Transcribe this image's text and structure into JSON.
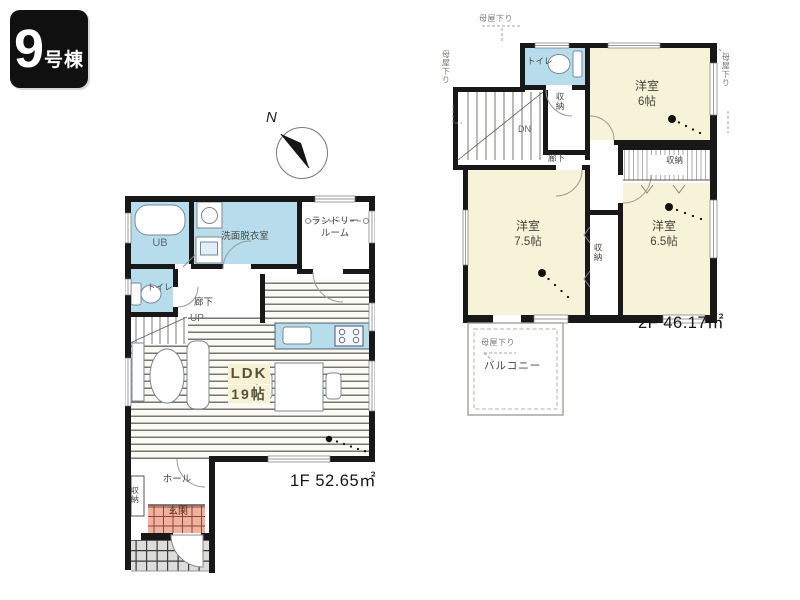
{
  "building_badge": {
    "number": "9",
    "suffix": "号棟"
  },
  "compass": {
    "north_label": "N"
  },
  "floor_1f": {
    "area_label": "1F 52.65㎡",
    "rooms": {
      "unit_bath": "UB",
      "washroom": "洗面脱衣室",
      "laundry_line1": "ランドリー",
      "laundry_line2": "ルーム",
      "toilet": "トイレ",
      "hallway": "廊下",
      "stairs": "UP",
      "ldk_name": "LDK",
      "ldk_size": "19帖",
      "hall": "ホール",
      "entrance": "玄関",
      "storage": "収納"
    }
  },
  "floor_2f": {
    "area_label": "2F 46.17㎡",
    "rooms": {
      "toilet": "トイレ",
      "bedroom_6_name": "洋室",
      "bedroom_6_size": "6帖",
      "bedroom_75_name": "洋室",
      "bedroom_75_size": "7.5帖",
      "bedroom_65_name": "洋室",
      "bedroom_65_size": "6.5帖",
      "stairs": "DN",
      "hallway": "廊下",
      "closet_hall": "収納",
      "closet_center": "収納",
      "closet_wall": "収納",
      "balcony": "バルコニー"
    },
    "annotations": {
      "roof_top": "母屋下り",
      "roof_left": "母屋下り",
      "roof_right": "母屋下り",
      "roof_balcony": "母屋下り"
    }
  },
  "colors": {
    "wall": "#181818",
    "wet_area_blue": "#b7dcec",
    "bedroom_cream": "#f7f3d8",
    "entrance_pink": "#edb2a0",
    "badge_bg": "#101010"
  }
}
